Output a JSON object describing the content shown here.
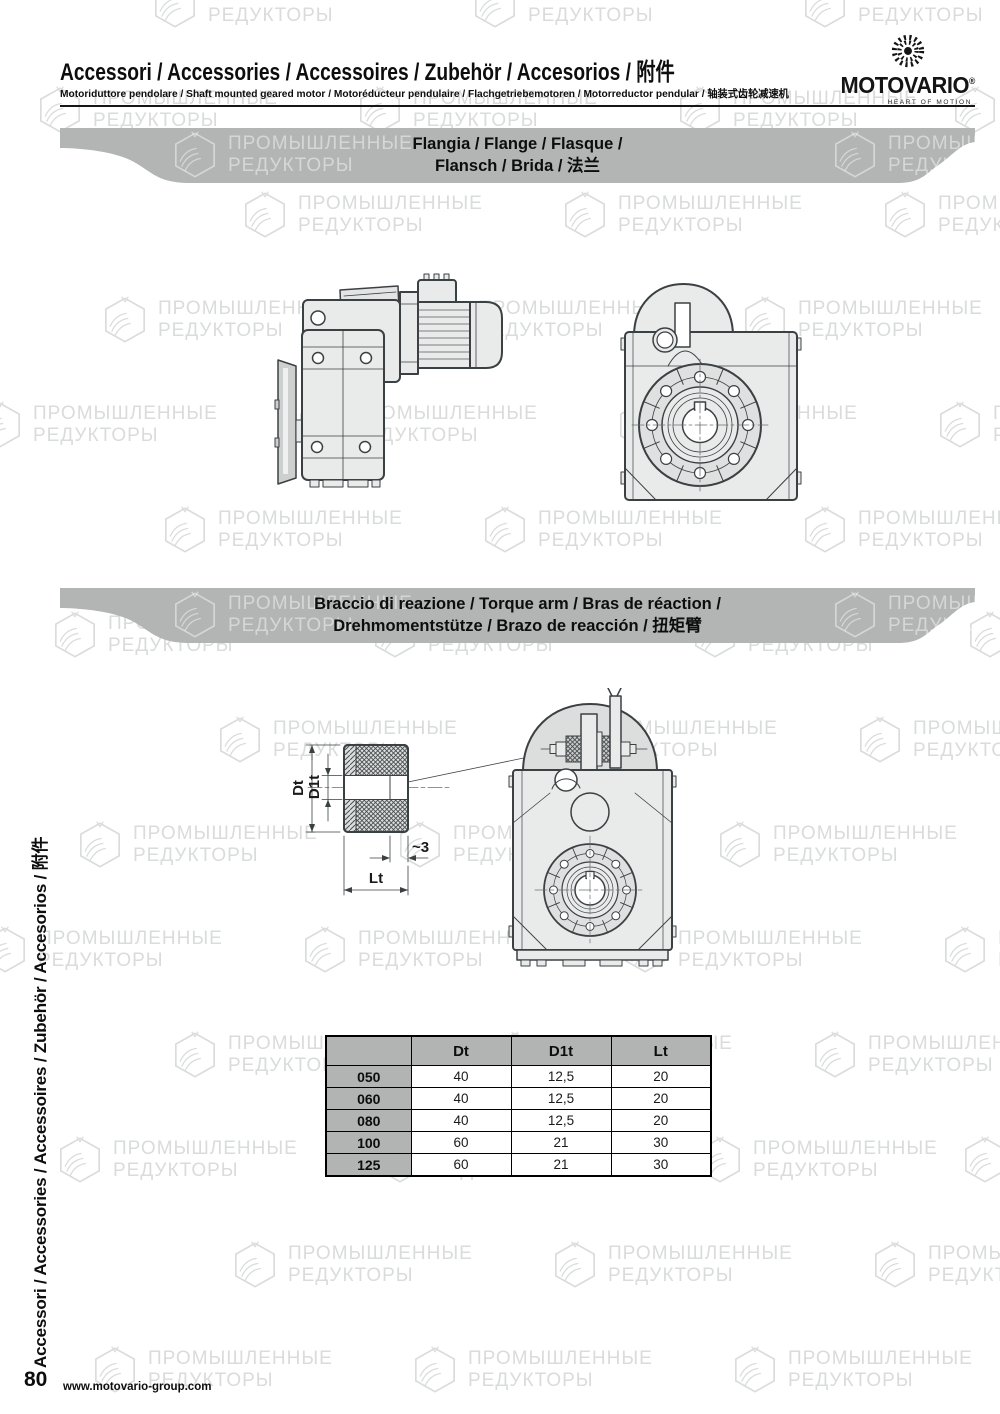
{
  "page": {
    "title": "Accessori / Accessories / Accessoires / Zubehör / Accesorios / 附件",
    "subtitle": "Motoriduttore pendolare / Shaft mounted geared motor / Motoréducteur pendulaire / Flachgetriebemotoren / Motorreductor pendular / 轴装式齿轮减速机",
    "sidebar_text": "Accessori / Accessories / Accessoires / Zubehör / Accesorios / 附件",
    "page_number": "80",
    "website": "www.motovario-group.com"
  },
  "logo": {
    "name": "MOTOVARIO",
    "registered": "®",
    "tagline": "HEART OF MOTION"
  },
  "banners": {
    "flange": {
      "line1": "Flangia / Flange / Flasque /",
      "line2": "Flansch / Brida / 法兰"
    },
    "torque_arm": {
      "line1": "Braccio di reazione / Torque arm / Bras de réaction /",
      "line2": "Drehmomentstütze / Brazo de reacción / 扭矩臂"
    }
  },
  "drawing_labels": {
    "dt": "Dt",
    "d1t": "D1t",
    "lt": "Lt",
    "approx3": "~3"
  },
  "table": {
    "headers": [
      "",
      "Dt",
      "D1t",
      "Lt"
    ],
    "rows": [
      {
        "id": "050",
        "dt": "40",
        "d1t": "12,5",
        "lt": "20"
      },
      {
        "id": "060",
        "dt": "40",
        "d1t": "12,5",
        "lt": "20"
      },
      {
        "id": "080",
        "dt": "40",
        "d1t": "12,5",
        "lt": "20"
      },
      {
        "id": "100",
        "dt": "60",
        "d1t": "21",
        "lt": "30"
      },
      {
        "id": "125",
        "dt": "60",
        "d1t": "21",
        "lt": "30"
      }
    ]
  },
  "watermark": {
    "line1": "ПРОМЫШЛЕННЫЕ",
    "line2": "РЕДУКТОРЫ"
  },
  "colors": {
    "banner_gray": "#b3b5b4",
    "table_gray": "#b2b4b3",
    "drawing_fill": "#e9ebea",
    "drawing_stroke": "#3b4043",
    "watermark_gray": "#d9dcdb"
  }
}
